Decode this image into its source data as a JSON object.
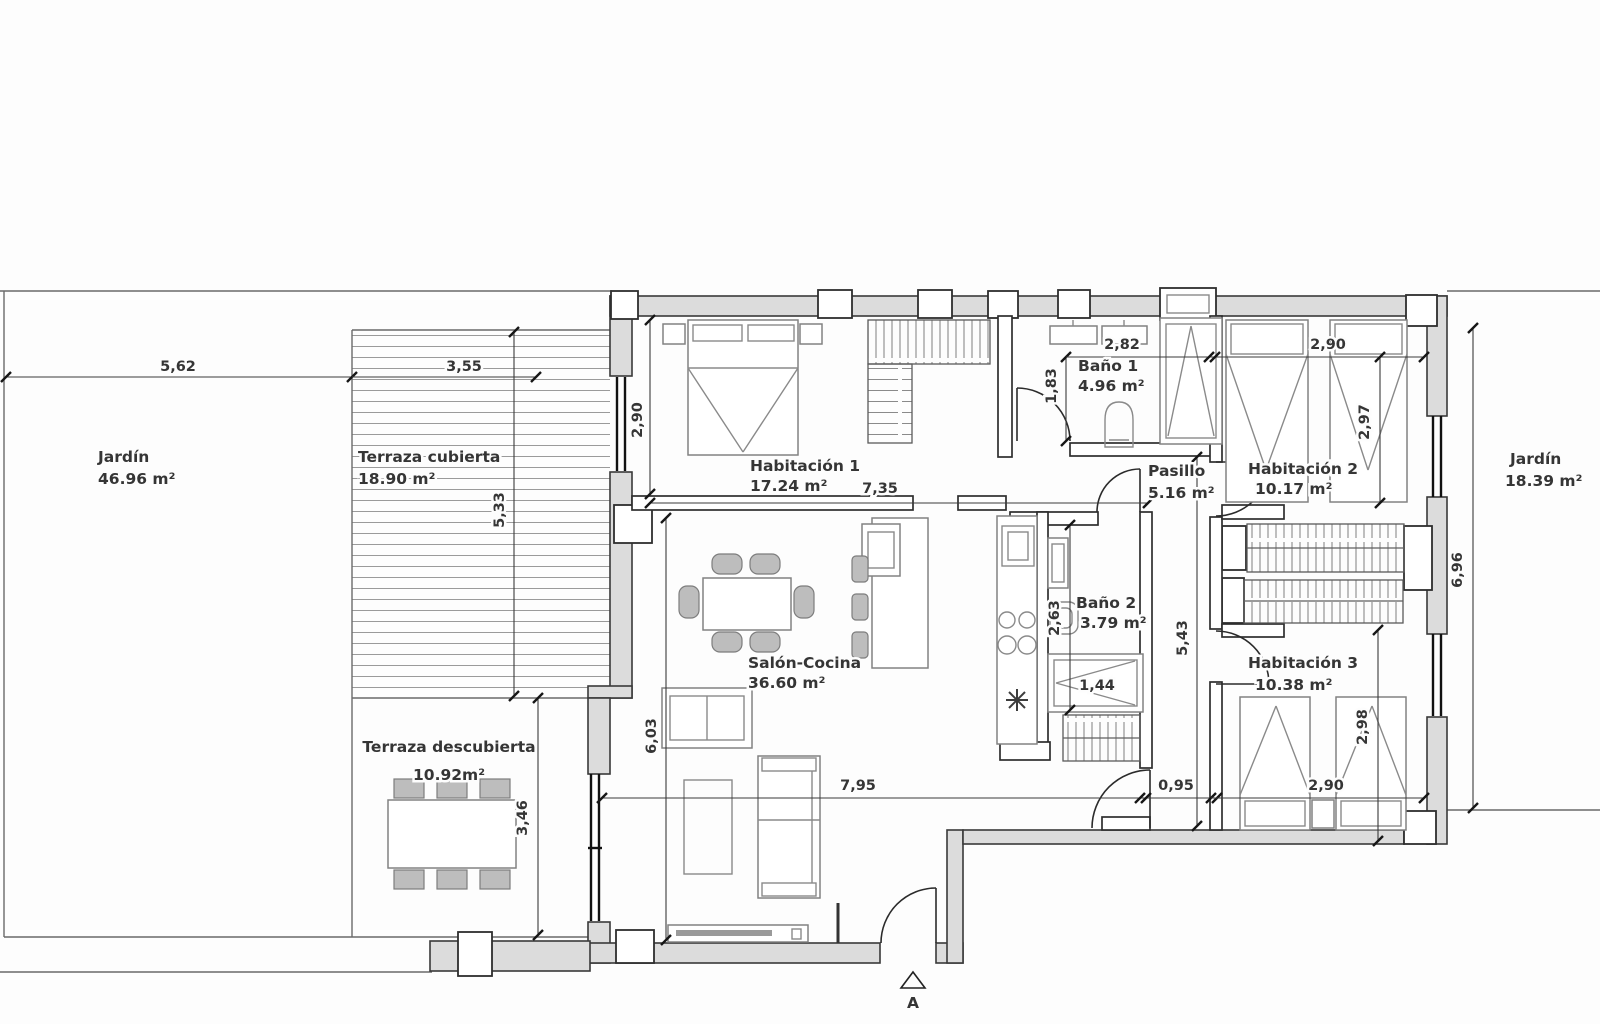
{
  "plan": {
    "rooms": {
      "jardin_left": {
        "name": "Jardín",
        "area": "46.96 m²"
      },
      "terraza_cubierta": {
        "name": "Terraza cubierta",
        "area": "18.90 m²"
      },
      "terraza_descubierta": {
        "name": "Terraza descubierta",
        "area": "10.92m²"
      },
      "habitacion_1": {
        "name": "Habitación 1",
        "area": "17.24 m²"
      },
      "bano_1": {
        "name": "Baño 1",
        "area": "4.96 m²"
      },
      "pasillo": {
        "name": "Pasillo",
        "area": "5.16 m²"
      },
      "habitacion_2": {
        "name": "Habitación 2",
        "area": "10.17 m²"
      },
      "salon_cocina": {
        "name": "Salón-Cocina",
        "area": "36.60 m²"
      },
      "bano_2": {
        "name": "Baño 2",
        "area": "3.79 m²"
      },
      "habitacion_3": {
        "name": "Habitación 3",
        "area": "10.38 m²"
      },
      "jardin_right": {
        "name": "Jardín",
        "area": "18.39 m²"
      }
    },
    "dimensions": {
      "jardin_width": "5,62",
      "terraza_width": "3,55",
      "terraza_height": "5,33",
      "hab1_height": "2,90",
      "hab1_width": "7,35",
      "bano1_height": "1,83",
      "bano1_width": "2,82",
      "hab2_width": "2,90",
      "hab2_height": "2,97",
      "bano2_height": "2,63",
      "shower_width": "1,44",
      "pasillo_height": "5,43",
      "pasillo_width": "0,95",
      "salon_width": "7,95",
      "salon_height": "6,03",
      "hab3_width": "2,90",
      "hab3_height": "2,98",
      "jardin_right_height": "6,96",
      "terraza_desc_height": "3,46"
    },
    "section_marker": "A",
    "colors": {
      "wall_fill": "#dcdcdc",
      "wall_stroke": "#3a3a3a",
      "text": "#353535",
      "furniture": "#8a8a8a"
    }
  }
}
